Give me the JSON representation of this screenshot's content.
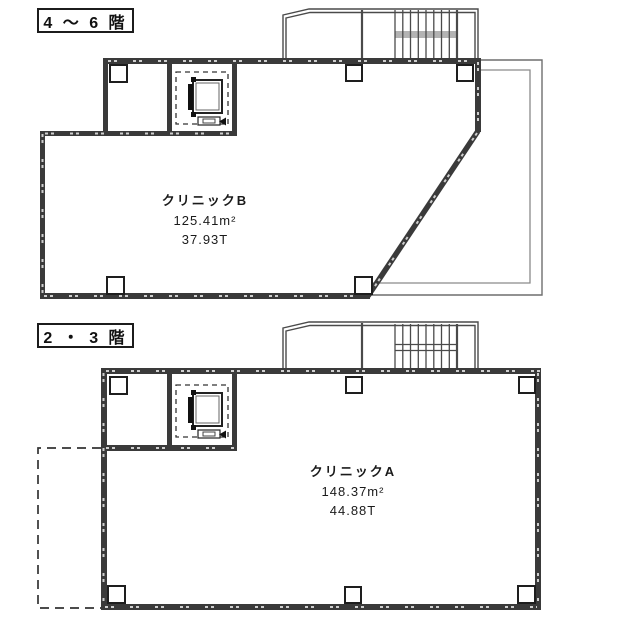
{
  "canvas": {
    "bg": "#ffffff",
    "wall_color": "#3a3a3a",
    "thin_line_color": "#4a4a4a",
    "ref_line_color": "#858585",
    "stair_band_color": "#b3b3b3",
    "text_color": "#1a1a1a"
  },
  "plans": {
    "upper": {
      "floor_label": "4 ～ 6 階",
      "unit": {
        "name": "クリニックB",
        "area": "125.41m²",
        "tsubo": "37.93T"
      }
    },
    "lower": {
      "floor_label": "2 ・ 3 階",
      "unit": {
        "name": "クリニックA",
        "area": "148.37m²",
        "tsubo": "44.88T"
      }
    }
  }
}
